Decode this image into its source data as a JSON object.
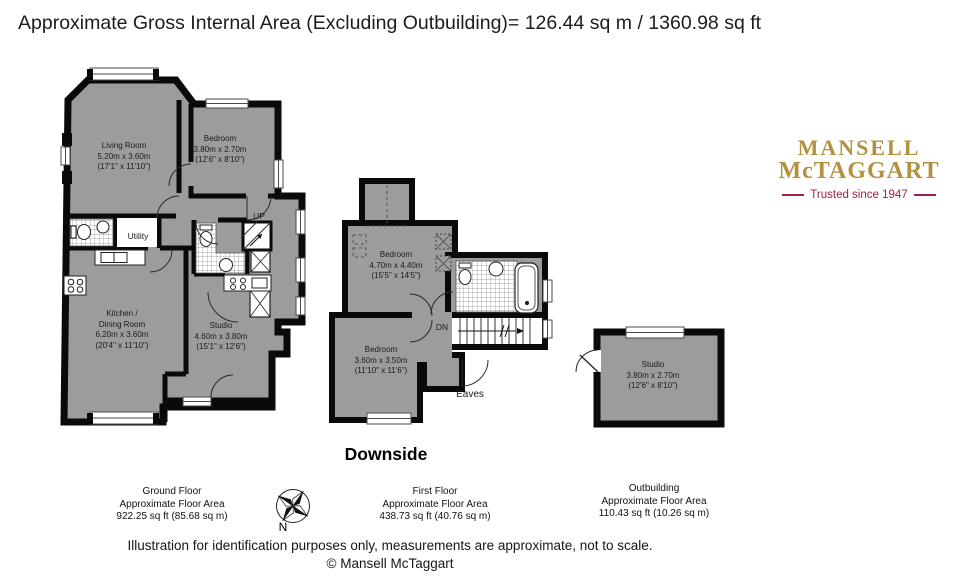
{
  "title": "Approximate Gross Internal Area (Excluding Outbuilding)= 126.44 sq m / 1360.98 sq ft",
  "property_name": "Downside",
  "logo": {
    "line1": "MANSELL",
    "line2": "McTAGGART",
    "tagline": "Trusted since 1947",
    "gold": "#b3913f",
    "maroon": "#a02244"
  },
  "plans": {
    "ground": {
      "rooms": {
        "living": {
          "lines": [
            "Living Room",
            "5.20m x 3.60m",
            "(17'1\" x 11'10\")"
          ]
        },
        "bedroom": {
          "lines": [
            "Bedroom",
            "3.80m x 2.70m",
            "(12'6\" x 8'10\")"
          ]
        },
        "utility": {
          "label": "Utility"
        },
        "kitchen": {
          "lines": [
            "Kitchen /",
            "Dining Room",
            "6.20m x 3.60m",
            "(20'4\" x 11'10\")"
          ]
        },
        "studio": {
          "lines": [
            "Studio",
            "4.60m x 3.80m",
            "(15'1\" x 12'6\")"
          ]
        },
        "up_label": "UP"
      },
      "footer": {
        "lines": [
          "Ground Floor",
          "Approximate Floor Area",
          "922.25 sq ft (85.68 sq m)"
        ]
      }
    },
    "first": {
      "rooms": {
        "bedroom1": {
          "lines": [
            "Bedroom",
            "4.70m x 4.40m",
            "(15'5\" x 14'5\")"
          ]
        },
        "bedroom2": {
          "lines": [
            "Bedroom",
            "3.60m x 3.50m",
            "(11'10\" x 11'6\")"
          ]
        },
        "dn_label": "DN",
        "eaves_label": "Eaves"
      },
      "footer": {
        "lines": [
          "First Floor",
          "Approximate Floor Area",
          "438.73 sq ft (40.76 sq m)"
        ]
      }
    },
    "outbuilding": {
      "rooms": {
        "studio": {
          "lines": [
            "Studio",
            "3.80m x 2.70m",
            "(12'6\" x 8'10\")"
          ]
        }
      },
      "footer": {
        "lines": [
          "Outbuilding",
          "Approximate Floor Area",
          "110.43 sq ft (10.26 sq m)"
        ]
      }
    }
  },
  "compass": {
    "north_label": "N"
  },
  "disclaimer": "Illustration for identification purposes only, measurements are approximate, not to scale.",
  "copyright": "© Mansell McTaggart",
  "colors": {
    "wall": "#0a0a0a",
    "room_fill": "#9c9c9c",
    "background": "#ffffff"
  }
}
